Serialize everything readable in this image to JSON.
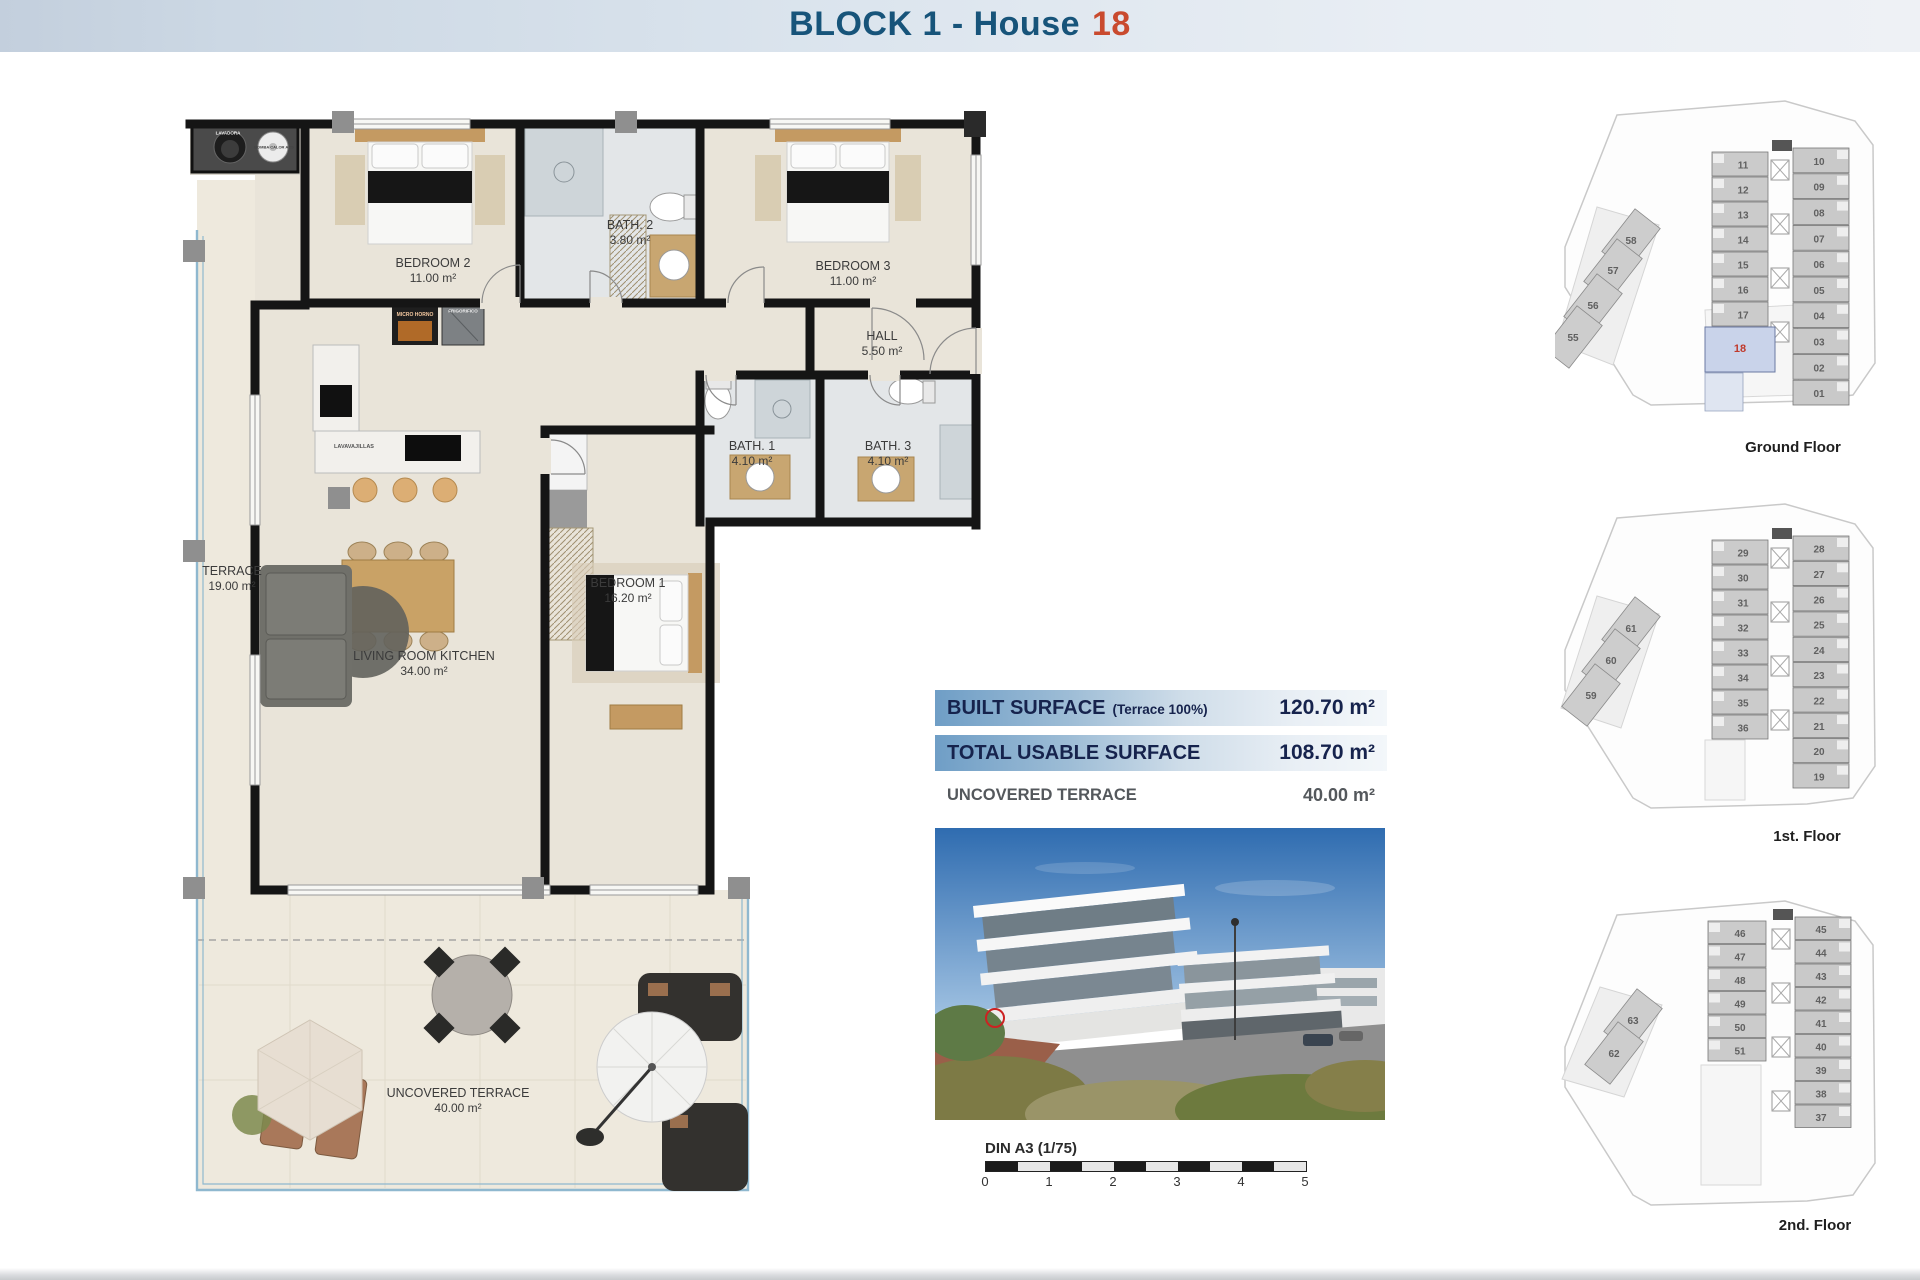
{
  "header": {
    "title_prefix": "BLOCK 1 - House",
    "title_number": "18"
  },
  "colors": {
    "title_blue": "#17547a",
    "number_orange": "#c94a2e",
    "surface_bar_blue": "#6f9ec6",
    "surface_text_navy": "#16234d",
    "highlight_unit_fill": "#c9d3ea",
    "highlight_unit_number": "#c0392b",
    "wall_black": "#151515",
    "floor_beige": "#e9e4d9",
    "terrace_beige": "#eee9dd",
    "glass_blue": "#8fb8cf"
  },
  "floorplan": {
    "rooms": [
      {
        "id": "terrace",
        "name": "TERRACE",
        "area": "19.00 m²"
      },
      {
        "id": "bedroom2",
        "name": "BEDROOM 2",
        "area": "11.00 m²"
      },
      {
        "id": "bath2",
        "name": "BATH. 2",
        "area": "3.80 m²"
      },
      {
        "id": "bedroom3",
        "name": "BEDROOM 3",
        "area": "11.00 m²"
      },
      {
        "id": "hall",
        "name": "HALL",
        "area": "5.50 m²"
      },
      {
        "id": "bath1",
        "name": "BATH. 1",
        "area": "4.10 m²"
      },
      {
        "id": "bath3",
        "name": "BATH. 3",
        "area": "4.10 m²"
      },
      {
        "id": "bedroom1",
        "name": "BEDROOM 1",
        "area": "16.20 m²"
      },
      {
        "id": "living",
        "name": "LIVING ROOM KITCHEN",
        "area": "34.00 m²"
      },
      {
        "id": "uncovered",
        "name": "UNCOVERED TERRACE",
        "area": "40.00 m²"
      }
    ],
    "appliance_labels": [
      {
        "id": "lavadora",
        "label": "LAVADORA"
      },
      {
        "id": "bomba",
        "label": "BOMBA CALOR ACS"
      },
      {
        "id": "micro",
        "label": "MICRO HORNO"
      },
      {
        "id": "frigo",
        "label": "FRIGORIFICO"
      },
      {
        "id": "lavavajillas",
        "label": "LAVAVAJILLAS"
      }
    ]
  },
  "surface_table": {
    "rows": [
      {
        "label": "BUILT SURFACE",
        "note": "(Terrace 100%)",
        "value": "120.70 m²",
        "highlight": true
      },
      {
        "label": "TOTAL USABLE SURFACE",
        "note": "",
        "value": "108.70 m²",
        "highlight": true
      },
      {
        "label": "UNCOVERED TERRACE",
        "note": "",
        "value": "40.00 m²",
        "highlight": false
      }
    ]
  },
  "scalebar": {
    "label": "DIN A3 (1/75)",
    "ticks": [
      "0",
      "1",
      "2",
      "3",
      "4",
      "5"
    ]
  },
  "floors": [
    {
      "label": "Ground Floor",
      "left_units": [
        "11",
        "12",
        "13",
        "14",
        "15",
        "16",
        "17",
        "18"
      ],
      "right_units": [
        "10",
        "09",
        "08",
        "07",
        "06",
        "05",
        "04",
        "03",
        "02",
        "01"
      ],
      "diagonal_units": [
        "58",
        "57",
        "56",
        "55"
      ],
      "highlight_unit": "18"
    },
    {
      "label": "1st. Floor",
      "left_units": [
        "29",
        "30",
        "31",
        "32",
        "33",
        "34",
        "35",
        "36"
      ],
      "right_units": [
        "28",
        "27",
        "26",
        "25",
        "24",
        "23",
        "22",
        "21",
        "20",
        "19"
      ],
      "diagonal_units": [
        "61",
        "60",
        "59"
      ],
      "highlight_unit": ""
    },
    {
      "label": "2nd. Floor",
      "left_units": [
        "46",
        "47",
        "48",
        "49",
        "50",
        "51"
      ],
      "right_units": [
        "45",
        "44",
        "43",
        "42",
        "41",
        "40",
        "39",
        "38",
        "37"
      ],
      "diagonal_units": [
        "63",
        "62"
      ],
      "highlight_unit": ""
    }
  ]
}
